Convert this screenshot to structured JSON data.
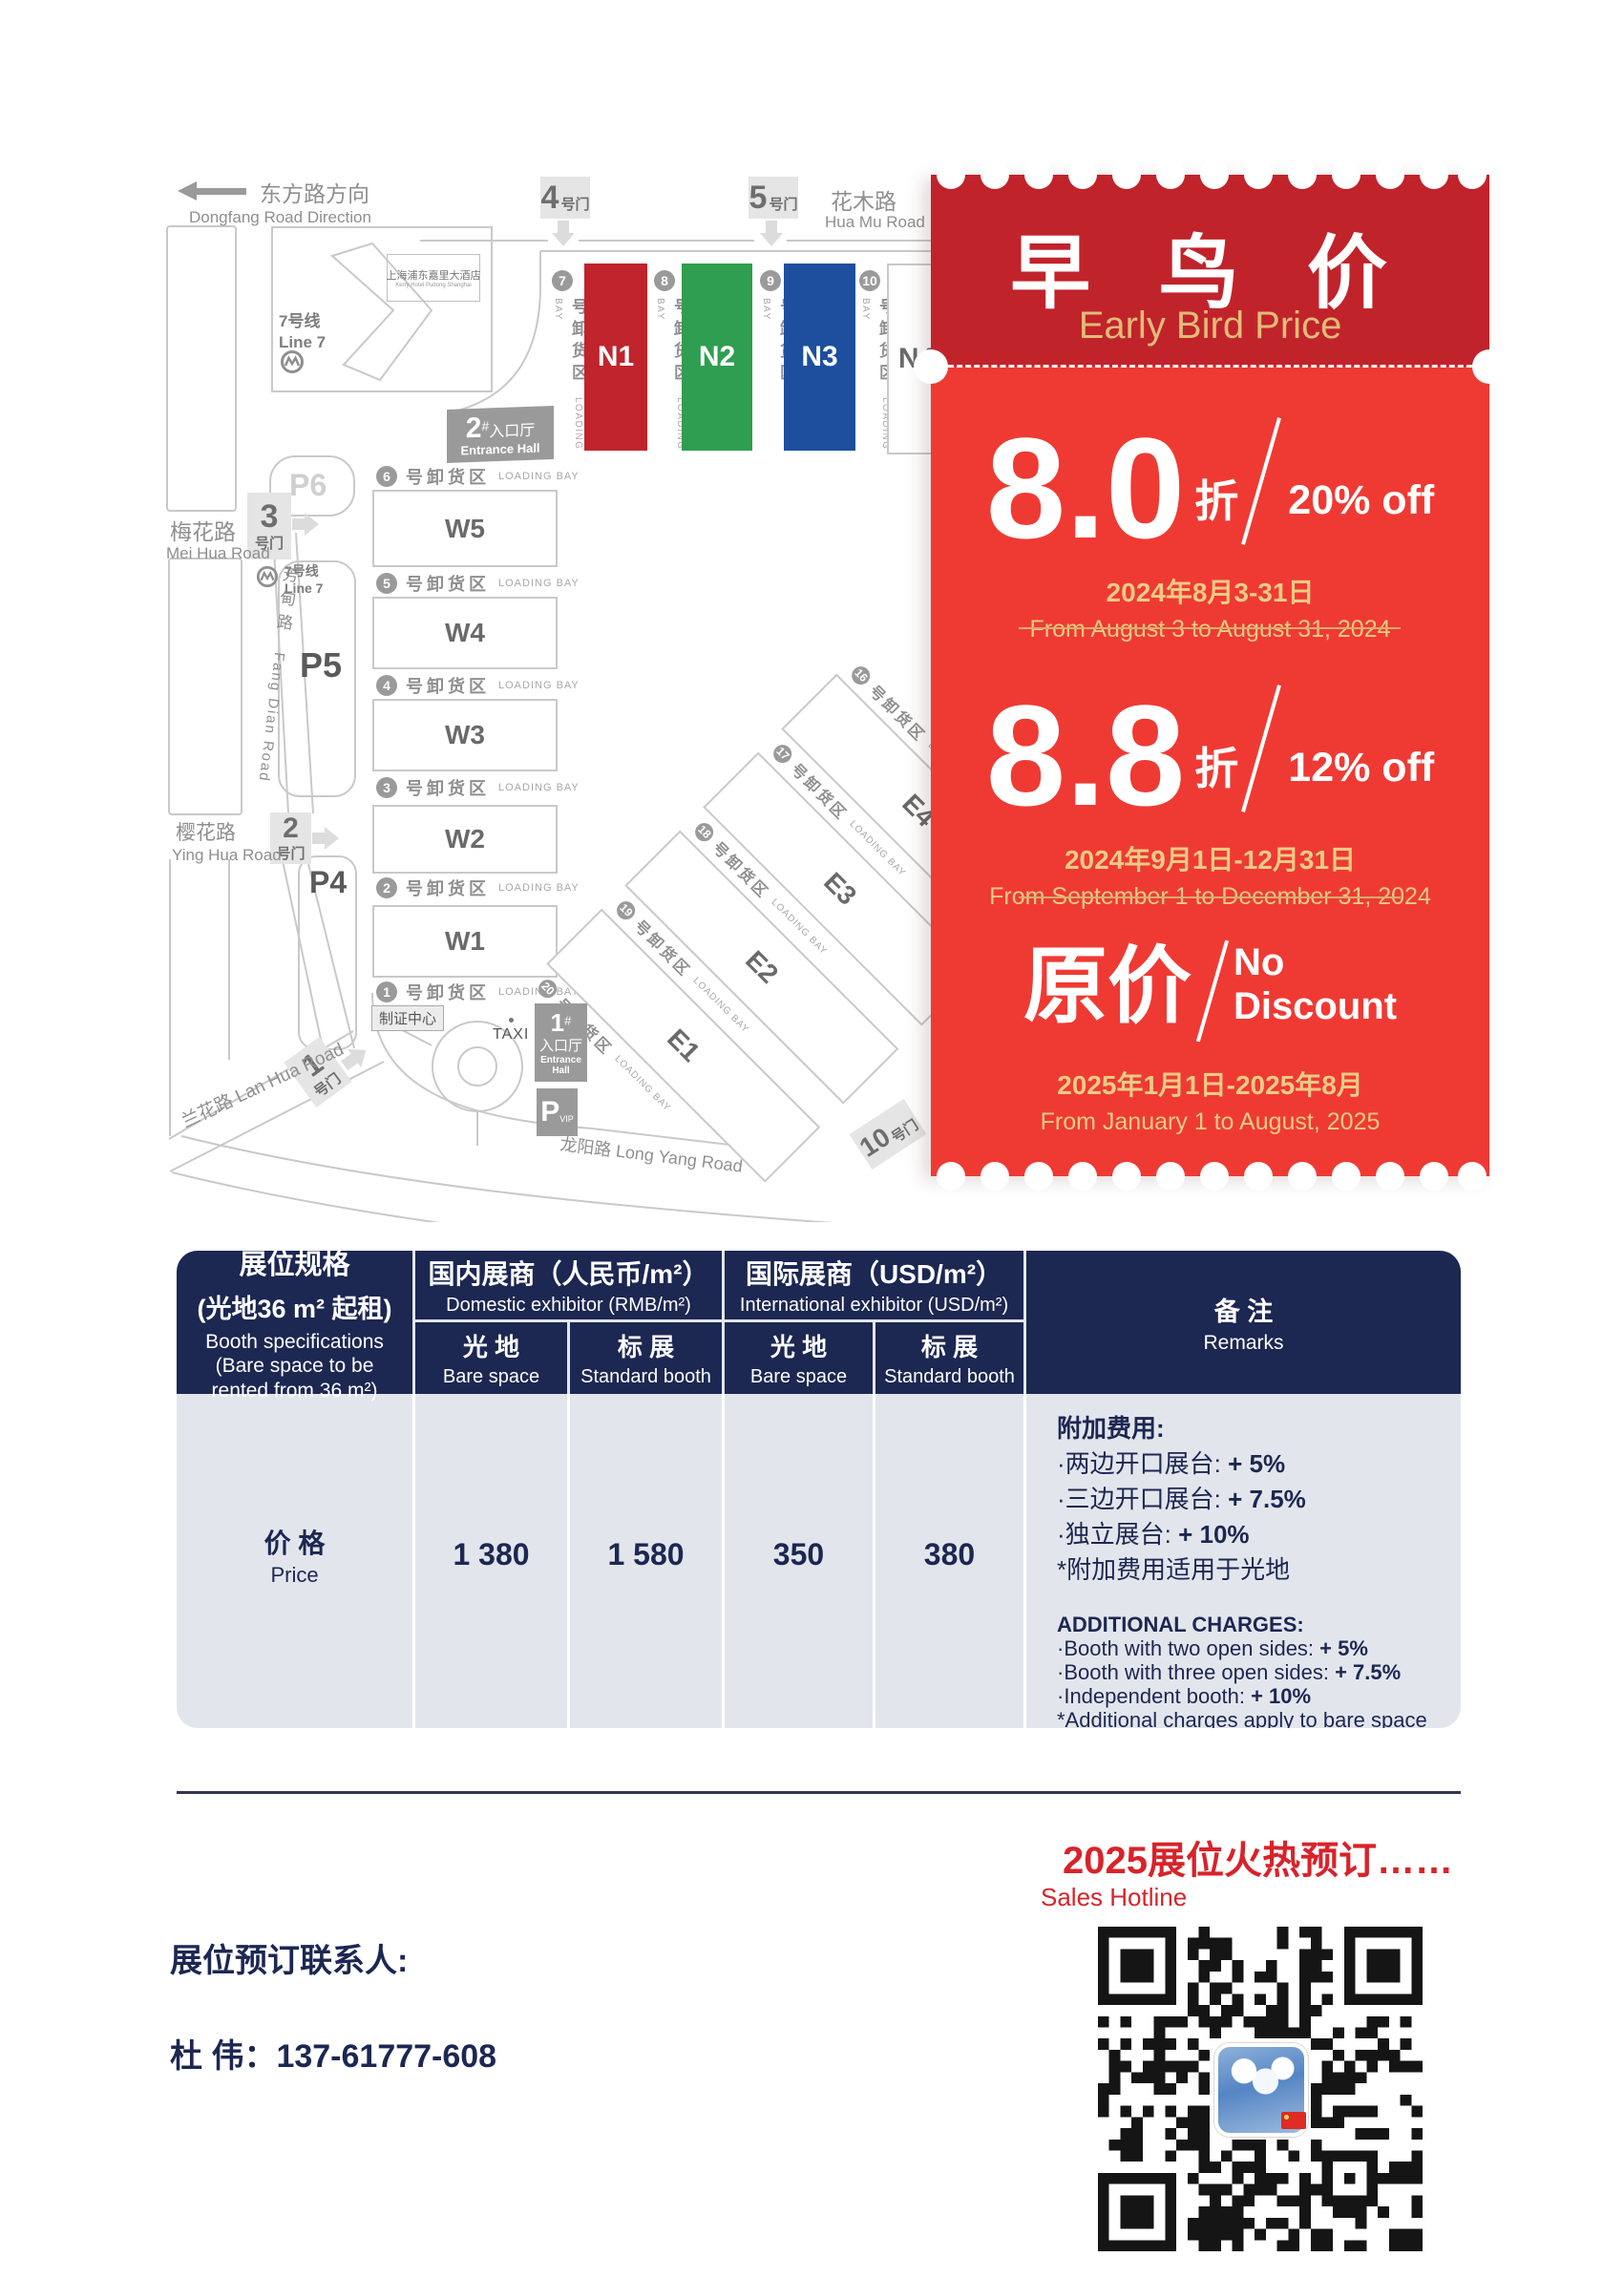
{
  "colors": {
    "coupon_header": "#c1232b",
    "coupon_body": "#ef3a33",
    "gold_text": "#e2bb79",
    "navy": "#1c2752",
    "table_body": "#e2e6ec",
    "footer_red": "#d8232a",
    "hall_n1": "#c0242c",
    "hall_n2": "#2f9e50",
    "hall_n3": "#1d4f9e"
  },
  "map": {
    "direction_zh": "东方路方向",
    "direction_en": "Dongfang Road Direction",
    "hotel_zh": "上海浦东嘉里大酒店",
    "hotel_en": "Kerry Hotel Pudong Shanghai",
    "line7_zh": "7号线",
    "line7_en": "Line 7",
    "roads": {
      "huamu_zh": "花木路",
      "huamu_en": "Hua Mu Road",
      "meihua_zh": "梅花路",
      "meihua_en": "Mei Hua Road",
      "yinghua_zh": "樱花路",
      "yinghua_en": "Ying Hua Road",
      "fangdian_zh": "芳甸路",
      "fangdian_en": "Fang Dian Road",
      "lanhua_zh": "兰花路",
      "lanhua_en": "Lan Hua Road",
      "longyang_zh": "龙阳路",
      "longyang_en": "Long Yang Road"
    },
    "gates": {
      "g1": "1",
      "g2": "2",
      "g3": "3",
      "g4": "4",
      "g5": "5",
      "g10": "10",
      "suffix": "号门"
    },
    "parking": {
      "p4": "P4",
      "p5": "P5",
      "p6": "P6",
      "vip_p": "P",
      "vip": "VIP"
    },
    "taxi": "TAXI",
    "badge_center": "制证中心",
    "entrance1_num": "1",
    "entrance2_num": "2",
    "entrance_hash": "#",
    "entrance_zh": "入口厅",
    "entrance_en": "Entrance Hall",
    "loading_zh": "号卸货区",
    "loading_en": "LOADING BAY",
    "n_halls": [
      "N1",
      "N2",
      "N3",
      "N4"
    ],
    "n_bays": [
      "7",
      "8",
      "9",
      "10"
    ],
    "w_halls": [
      "W5",
      "W4",
      "W3",
      "W2",
      "W1"
    ],
    "w_bays": [
      "6",
      "5",
      "4",
      "3",
      "2",
      "1"
    ],
    "e_rows": [
      {
        "type": "bay",
        "num": "16"
      },
      {
        "type": "hall",
        "id": "E4"
      },
      {
        "type": "bay",
        "num": "17"
      },
      {
        "type": "hall",
        "id": "E3"
      },
      {
        "type": "bay",
        "num": "18"
      },
      {
        "type": "hall",
        "id": "E2"
      },
      {
        "type": "bay",
        "num": "19"
      },
      {
        "type": "hall",
        "id": "E1"
      },
      {
        "type": "bay",
        "num": "20"
      }
    ]
  },
  "coupon": {
    "title_zh": "早 鸟 价",
    "title_en": "Early Bird Price",
    "tier1": {
      "num": "8.0",
      "zhe": "折",
      "off": "20% off",
      "date_zh": "2024年8月3-31日",
      "date_en": "From August 3 to August 31, 2024"
    },
    "tier2": {
      "num": "8.8",
      "zhe": "折",
      "off": "12% off",
      "date_zh": "2024年9月1日-12月31日",
      "date_en": "From September 1 to December 31, 2024"
    },
    "tier3": {
      "zh": "原价",
      "no1": "No",
      "no2": "Discount",
      "date_zh": "2025年1月1日-2025年8月",
      "date_en": "From January 1 to August, 2025"
    }
  },
  "table": {
    "spec_zh": "展位规格",
    "spec_zh2": "(光地36 m² 起租)",
    "spec_en": "Booth specifications",
    "spec_en2": "(Bare space to be rented from 36 m²)",
    "domestic_zh": "国内展商（人民币/m²）",
    "domestic_en": "Domestic exhibitor (RMB/m²)",
    "intl_zh": "国际展商（USD/m²）",
    "intl_en": "International exhibitor (USD/m²)",
    "bare_zh": "光 地",
    "bare_en": "Bare space",
    "std_zh": "标 展",
    "std_en": "Standard booth",
    "remarks_zh": "备 注",
    "remarks_en": "Remarks",
    "price_zh": "价 格",
    "price_en": "Price",
    "values": [
      "1 380",
      "1 580",
      "350",
      "380"
    ],
    "remarks": {
      "zh_title": "附加费用:",
      "zh_items": [
        {
          "t": "·两边开口展台: ",
          "b": "+ 5%"
        },
        {
          "t": "·三边开口展台: ",
          "b": "+ 7.5%"
        },
        {
          "t": "·独立展台: ",
          "b": "+ 10%"
        },
        {
          "t": "*附加费用适用于光地",
          "b": ""
        }
      ],
      "en_title": "ADDITIONAL CHARGES:",
      "en_items": [
        {
          "t": "·Booth with two open sides: ",
          "b": "+ 5%"
        },
        {
          "t": "·Booth with three open sides: ",
          "b": "+ 7.5%"
        },
        {
          "t": "·Independent booth: ",
          "b": "+ 10%"
        },
        {
          "t": "*Additional charges apply to bare space",
          "b": ""
        }
      ]
    }
  },
  "footer": {
    "hot": "2025展位火热预订……",
    "hotline": "Sales Hotline",
    "contact_label": "展位预订联系人:",
    "contact_name": "杜  伟：137-61777-608"
  }
}
